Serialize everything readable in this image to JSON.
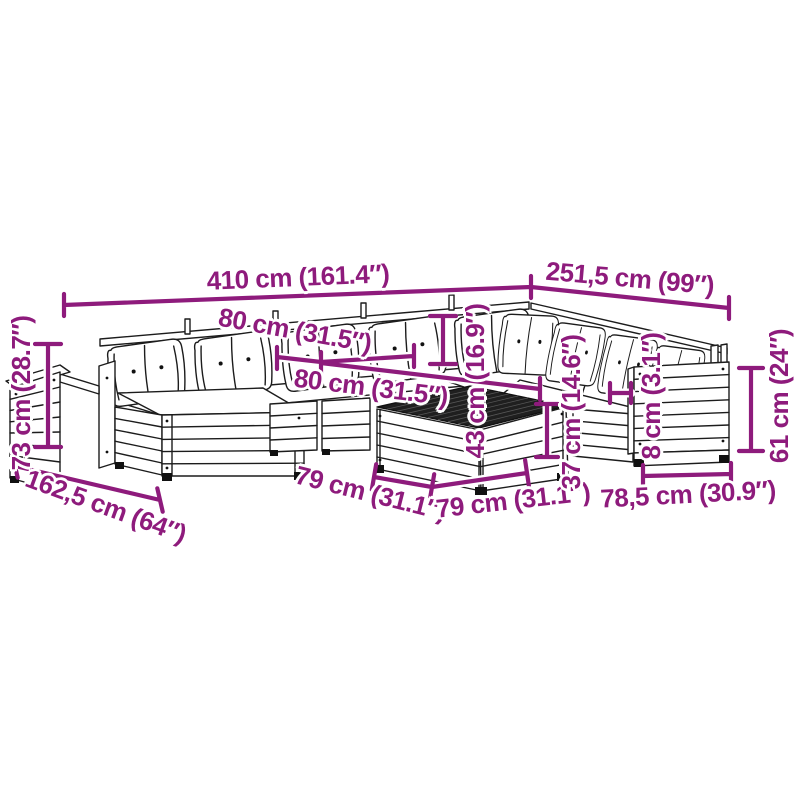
{
  "image": {
    "type": "product dimension diagram",
    "subject": "garden lounge furniture set line drawing with cushions, ottomans and slatted table",
    "background_color": "#ffffff",
    "drawing_line_color": "#1c1c1c",
    "accent_color": "#8E1B7C",
    "table_top_color": "#1f1f1f"
  },
  "labels": {
    "total_width": "410 cm (161.4″)",
    "right_depth": "251,5 cm (99″)",
    "module_width_a": "80 cm (31.5″)",
    "module_width_b": "80 cm (31.5″)",
    "left_height": "73 cm (28.7″)",
    "left_depth": "162,5 cm (64″)",
    "table_side_a": "79 cm (31.1″)",
    "table_side_b": "79 cm (31.1″)",
    "backrest_height": "43 cm (16.9″)",
    "seat_height": "37 cm (14.6″)",
    "armrest_width": "8 cm (3.1″)",
    "armrest_height": "61 cm (24″)",
    "end_module_width": "78,5 cm (30.9″)"
  }
}
